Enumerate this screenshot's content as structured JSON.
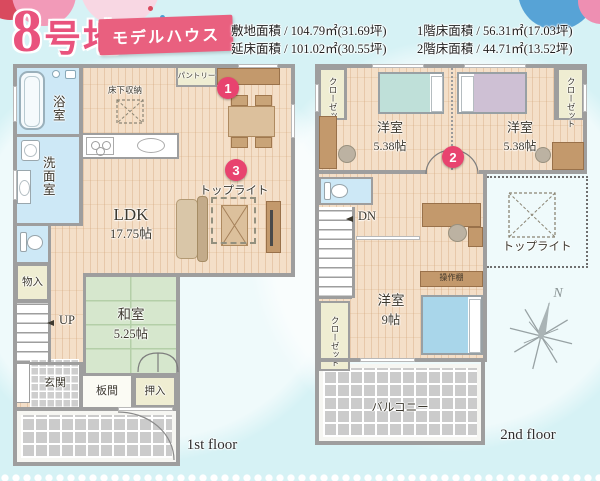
{
  "header": {
    "lot_title": "8号地",
    "badge": "モデルハウス",
    "area_items": [
      "敷地面積 / 104.79㎡(31.69坪)",
      "延床面積 / 101.02㎡(30.55坪)",
      "1階床面積 / 56.31㎡(17.03坪)",
      "2階床面積 / 44.71㎡(13.52坪)"
    ]
  },
  "floor1": {
    "caption": "1st floor",
    "labels": {
      "bath": "浴室",
      "washroom": "洗面室",
      "pantry": "パントリー",
      "underfloor_storage": "床下収納",
      "ldk_name": "LDK",
      "ldk_size": "17.75帖",
      "toplight": "トップライト",
      "washitsu_name": "和室",
      "washitsu_size": "5.25帖",
      "storage": "物入",
      "up": "UP",
      "entrance": "玄関",
      "itanoma": "板間",
      "oshiire": "押入"
    },
    "marker_dining": "1",
    "marker_toplight": "3"
  },
  "floor2": {
    "caption": "2nd floor",
    "labels": {
      "closet": "クローゼット",
      "bedroom_small_name": "洋室",
      "bedroom_small_size": "5.38帖",
      "dn": "DN",
      "shelf": "操作棚",
      "bedroom_main_name": "洋室",
      "bedroom_main_size": "9帖",
      "toplight": "トップライト",
      "balcony": "バルコニー",
      "north": "N"
    },
    "marker_hall": "2"
  },
  "colors": {
    "accent_pink": "#e8537c",
    "marker_pink": "#e8436f",
    "wall_gray": "#9e9e9e",
    "background_cyan": "#d6f2f5",
    "wood_floor": "#f4dfc8",
    "tatami_green": "#d6e7cd",
    "water_blue": "#cde8f6"
  }
}
